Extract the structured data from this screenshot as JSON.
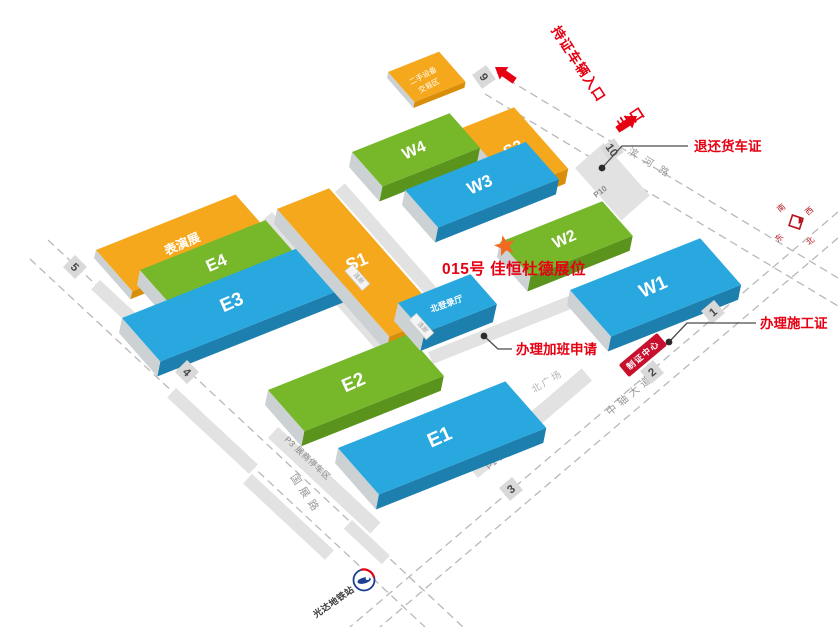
{
  "halls": [
    {
      "id": "E4",
      "label": "E4",
      "type": "green"
    },
    {
      "id": "E3",
      "label": "E3",
      "type": "blue"
    },
    {
      "id": "S1",
      "label": "S1",
      "type": "orange"
    },
    {
      "id": "S2",
      "label": "S2",
      "type": "orange"
    },
    {
      "id": "W4",
      "label": "W4",
      "type": "green"
    },
    {
      "id": "W3",
      "label": "W3",
      "type": "blue"
    },
    {
      "id": "E2",
      "label": "E2",
      "type": "green"
    },
    {
      "id": "W2",
      "label": "W2",
      "type": "green"
    },
    {
      "id": "W1",
      "label": "W1",
      "type": "blue"
    },
    {
      "id": "E1",
      "label": "E1",
      "type": "blue"
    }
  ],
  "areas": {
    "performance": "表演展",
    "secondhand_line1": "二手设备",
    "secondhand_line2": "交易区",
    "north_hall": "北登录厅",
    "corridor": "连廊",
    "plaza": "北广场",
    "cert_center": "制证中心",
    "p10": "P10",
    "p1": "P1 贵宾停车区",
    "p3": "P3 展商停车区"
  },
  "roads": {
    "binhe": "滨河路",
    "zhongzhou": "中轴大道",
    "guozhan": "国展路"
  },
  "gates": [
    "9",
    "10",
    "5",
    "4",
    "1",
    "2",
    "3"
  ],
  "annotations": {
    "entrance": "持证车辆入口",
    "exit": "出口",
    "truck": "退还货车证",
    "overtime": "办理加班申请",
    "construction": "办理施工证",
    "booth": "015号 佳恒杜德展位"
  },
  "metro": "光达地铁站",
  "compass": {
    "n": "北",
    "s": "南",
    "e": "东",
    "w": "西"
  },
  "colors": {
    "blue": "#29a8e0",
    "green": "#76b82a",
    "orange": "#f6a81c",
    "blue_dark": "#1d7fae",
    "green_dark": "#5a941c",
    "orange_dark": "#d88d0b",
    "side_gray": "#ccd1d4",
    "strip_gray": "#e2e2e2",
    "road_gray": "#b8b8b8",
    "text_gray": "#9a9a9a",
    "red": "#e60012",
    "dark_red": "#c8102e",
    "star_orange": "#f26a22",
    "metro_blue": "#1c3f94"
  }
}
